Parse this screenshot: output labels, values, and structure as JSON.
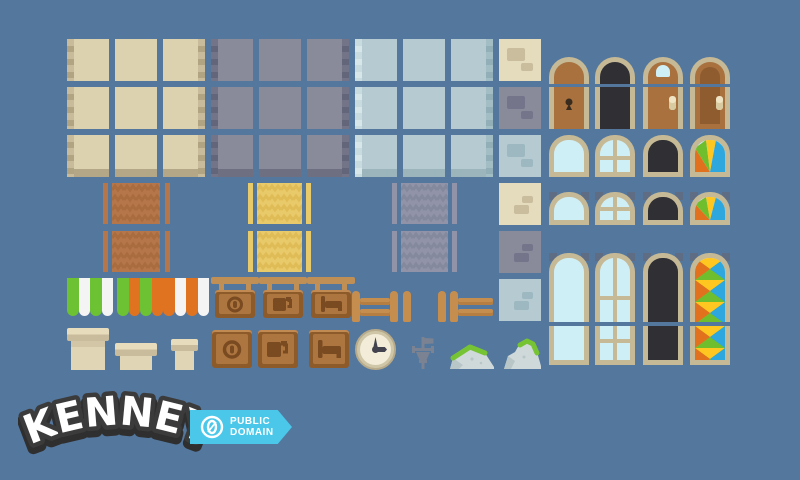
{
  "app": {
    "title": "Kenney pixel town asset sheet preview",
    "background": "#54779e"
  },
  "logo": {
    "text": "KENNEY"
  },
  "badge": {
    "symbol": "0",
    "line1": "PUBLIC",
    "line2": "DOMAIN"
  },
  "colors": {
    "bg": "#54779e",
    "cream_body": "#dcd2b0",
    "cream_edge_a": "#c7bb9b",
    "cream_edge_b": "#b1a483",
    "cream_band": "#b4a787",
    "cream_brick_bg": "#e5dcbd",
    "cream_brick": "#c9bd9e",
    "gray_body": "#8a8b9a",
    "gray_edge_a": "#737487",
    "gray_edge_b": "#63657a",
    "gray_band": "#6e7081",
    "gray_brick": "#74758a",
    "blue_body": "#b5cbd1",
    "blue_edge_a": "#c8dbdf",
    "blue_edge_b": "#d6e6e9",
    "blue_edge_ra": "#a3bdc4",
    "blue_edge_rb": "#92afb8",
    "blue_band": "#9cb5bd",
    "blue_brick": "#9db8c0",
    "frame": "#c6b995",
    "glass": "#cfeff7",
    "dark": "#2f2f34",
    "corner_shadow": "#5e6d84",
    "door": "#a8713e",
    "door_panel": "#8f5c30",
    "handle": "#efe4c4",
    "handle_dark": "#d9cba1",
    "keyhole": "#392c1f",
    "stain_green": "#6fbe2e",
    "stain_yellow": "#ffc71f",
    "stain_blue": "#2ea7df",
    "stain_orange": "#e2711d",
    "carpet_orange": "#b5764a",
    "carpet_orange_dark": "#a96c3f",
    "carpet_yellow": "#e9ca6b",
    "carpet_yellow_dark": "#dfbc55",
    "carpet_gray": "#9194a8",
    "carpet_gray_dark": "#85899e",
    "awning_green": "#6cc233",
    "awning_orange": "#e0731f",
    "awning_white": "#f4f4f4",
    "wood": "#c68e4e",
    "wood_dark": "#b67f41",
    "sign_bar": "#bf8f56",
    "sign_frame": "#8d5a2a",
    "sign_panel": "#ad7640",
    "sign_icon": "#7a4a21",
    "sign_top": "#c18a52",
    "chimney": "#e0d6b5",
    "chimney_light": "#e7ddbd",
    "chimney_cap": "#c9bc9c",
    "chimney_shade": "#d2c6a6",
    "clock_ring": "#cfc6a7",
    "clock_edge": "#b7ab8b",
    "clock_face": "#f2ecd8",
    "clock_hand": "#42434e",
    "vane": "#7b8292",
    "rock": "#cfd9da",
    "rock_dark": "#b9c6c8",
    "grass": "#76c433",
    "logo_outline": "#3b3b3b",
    "logo_shadow": "#2f2f2f",
    "logo_fill": "#ffffff",
    "badge_blue": "#4ac7e9"
  },
  "sheet": {
    "wall_tilesets": [
      {
        "name": "cream-plaster",
        "tiles": 9
      },
      {
        "name": "purple-gray-plaster",
        "tiles": 9
      },
      {
        "name": "blue-gray-plaster",
        "tiles": 9
      }
    ],
    "brick_detail_tiles": [
      "cream-a",
      "gray-a",
      "blue-a",
      "cream-b",
      "gray-b",
      "blue-b"
    ],
    "carpets": [
      "orange-chevron",
      "yellow-chevron",
      "gray-chevron"
    ],
    "awnings": [
      "green-white",
      "green-orange",
      "orange-white"
    ],
    "hanging_signs": [
      "coin",
      "mug",
      "bed"
    ],
    "flat_signs": [
      "coin",
      "mug",
      "bed"
    ],
    "doors": [
      "wood-keyhole",
      "open-dark",
      "wood-window-handle",
      "wood-inset-panel"
    ],
    "arch_windows": [
      "plain",
      "four-pane",
      "dark",
      "stained-glass"
    ],
    "half_windows": [
      "plain",
      "four-pane",
      "dark",
      "stained-glass"
    ],
    "tall_windows": [
      "plain",
      "multi-pane",
      "dark",
      "stained-glass"
    ],
    "props": [
      "fence",
      "fence-post",
      "chimney-large",
      "chimney-medium",
      "chimney-small",
      "clock",
      "weather-vane",
      "rock-wide",
      "rock-tall"
    ]
  }
}
